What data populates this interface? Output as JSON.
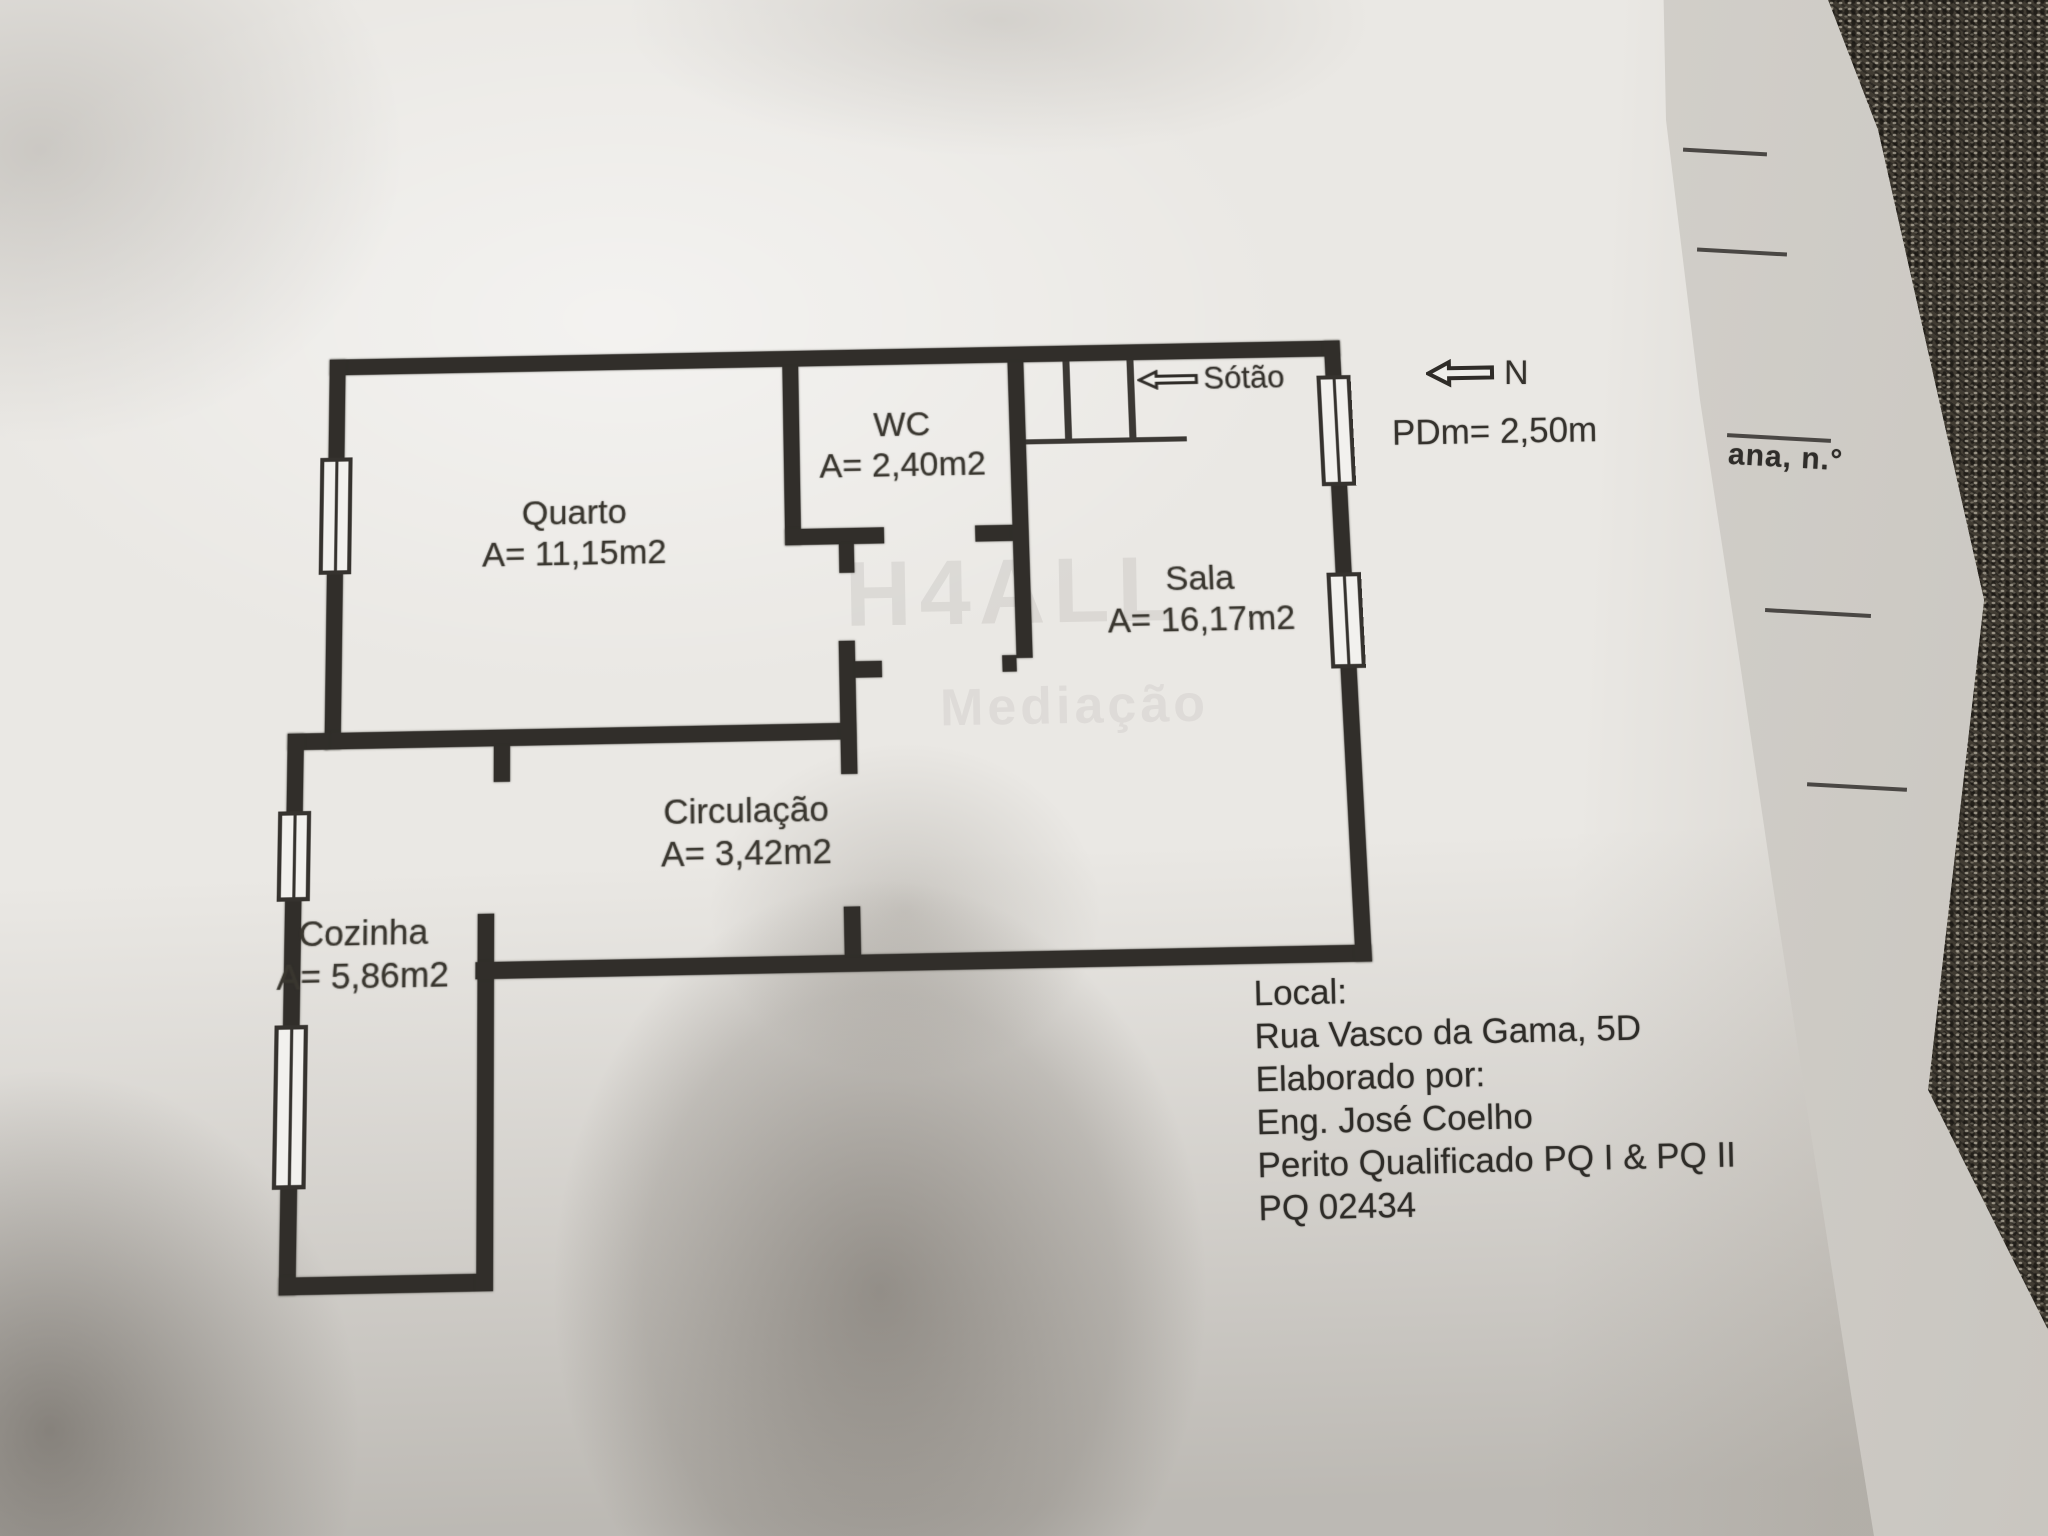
{
  "floor_plan": {
    "rooms": [
      {
        "name": "Quarto",
        "area": "A= 11,15m2"
      },
      {
        "name": "WC",
        "area": "A= 2,40m2"
      },
      {
        "name": "Sala",
        "area": "A= 16,17m2"
      },
      {
        "name": "Circulação",
        "area": "A= 3,42m2"
      },
      {
        "name": "Cozinha",
        "area": "A= 5,86m2"
      }
    ],
    "attic_label": "Sótão",
    "north_label": "N",
    "ceiling_height_label": "PDm= 2,50m",
    "watermark_line1": "H4ALL",
    "watermark_line2": "Mediação"
  },
  "info_block": {
    "lines": [
      "Local:",
      "Rua Vasco da Gama, 5D",
      "Elaborado por:",
      "Eng. José Coelho",
      "Perito Qualificado PQ I & PQ II",
      "PQ 02434"
    ]
  },
  "underlying_page": {
    "partial_text": "ana, n.°"
  },
  "colors": {
    "wall": "#312e2a",
    "paper": "#eae8e4",
    "behind_paper": "#d9d6d1",
    "fabric": "#413c33",
    "ink": "#2e2c28"
  }
}
